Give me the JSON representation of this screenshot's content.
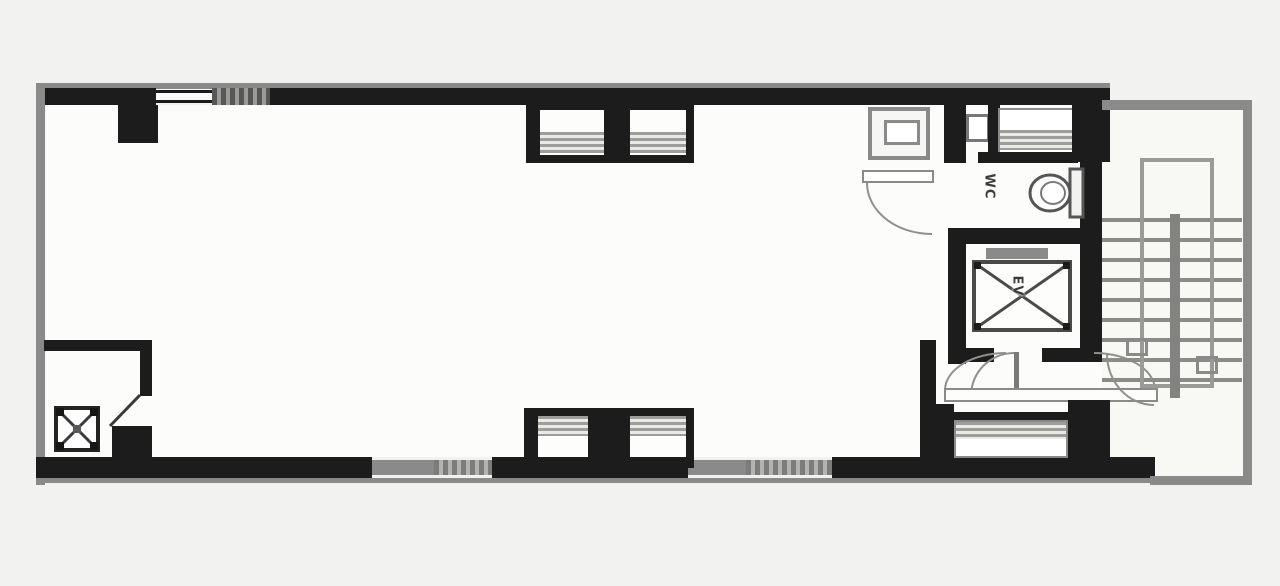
{
  "plan": {
    "type": "architectural-floor-plan",
    "labels": {
      "wc": "WC",
      "ev": "EV"
    },
    "colors": {
      "wall": "#1c1c1c",
      "line_gray": "#8a8a8a",
      "background": "#f2f2f0",
      "interior": "#fcfcfb"
    },
    "features": [
      "open-office-area",
      "wc-room-with-toilet",
      "elevator-shaft-with-cross",
      "switchback-stairwell",
      "pipe-shaft-box",
      "kitchenette-sink",
      "window-bays",
      "double-entry-doors"
    ]
  }
}
